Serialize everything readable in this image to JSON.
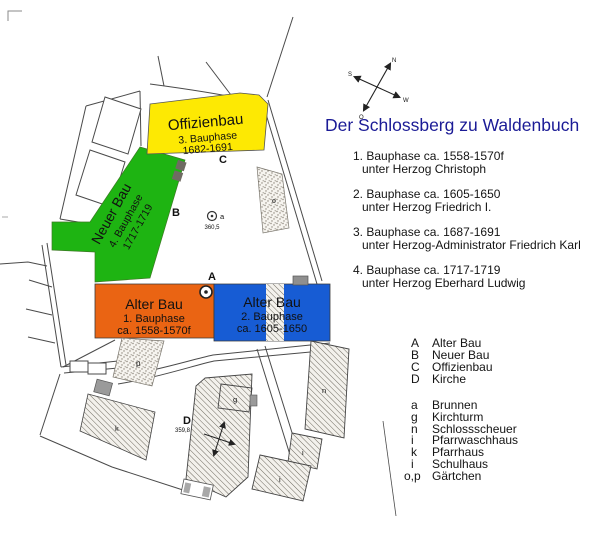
{
  "title": "Der Schlossberg zu Waldenbuch",
  "phases": [
    {
      "line1": "1. Bauphase  ca. 1558-1570f",
      "line2": "unter Herzog Christoph"
    },
    {
      "line1": "2. Bauphase  ca. 1605-1650",
      "line2": "unter Herzog Friedrich I."
    },
    {
      "line1": "3. Bauphase  ca. 1687-1691",
      "line2": "unter Herzog-Administrator Friedrich Karl"
    },
    {
      "line1": "4. Bauphase  ca. 1717-1719",
      "line2": "unter Herzog Eberhard Ludwig"
    }
  ],
  "legend_buildings": [
    {
      "key": "A",
      "name": "Alter Bau"
    },
    {
      "key": "B",
      "name": "Neuer Bau"
    },
    {
      "key": "C",
      "name": "Offizienbau"
    },
    {
      "key": "D",
      "name": "Kirche"
    }
  ],
  "legend_features": [
    {
      "key": "a",
      "name": "Brunnen"
    },
    {
      "key": "g",
      "name": "Kirchturm"
    },
    {
      "key": "n",
      "name": "Schlossscheuer"
    },
    {
      "key": "i",
      "name": "Pfarrwaschhaus"
    },
    {
      "key": "k",
      "name": "Pfarrhaus"
    },
    {
      "key": "i",
      "name": "Schulhaus"
    },
    {
      "key": "o,p",
      "name": "Gärtchen"
    }
  ],
  "map": {
    "offizienbau": {
      "name": "Offizienbau",
      "phase": "3. Bauphase",
      "years": "1682-1691",
      "color": "#fde903",
      "label": "C"
    },
    "neuer_bau": {
      "name": "Neuer Bau",
      "phase": "4. Bauphase",
      "years": "1717-1719",
      "color": "#1eb412",
      "label": "B"
    },
    "alter_bau_1": {
      "name": "Alter Bau",
      "phase": "1. Bauphase",
      "years": "ca. 1558-1570f",
      "color": "#ea6413",
      "label": "A"
    },
    "alter_bau_2": {
      "name": "Alter Bau",
      "phase": "2. Bauphase",
      "years": "ca. 1605-1650",
      "color": "#175cd4"
    },
    "well": {
      "label": "a",
      "elevation": "360,5"
    },
    "church": {
      "label": "D",
      "elevation": "359,8",
      "tower_label": "g"
    },
    "features": {
      "pfarrhaus": "k",
      "scheuer": "n",
      "waschhaus": "i",
      "schulhaus": "i",
      "garden_o": "o",
      "garden_p": "p"
    },
    "compass": {
      "n": "N",
      "e": "O",
      "s": "S",
      "w": "W"
    },
    "title_color": "#1b1b96"
  }
}
